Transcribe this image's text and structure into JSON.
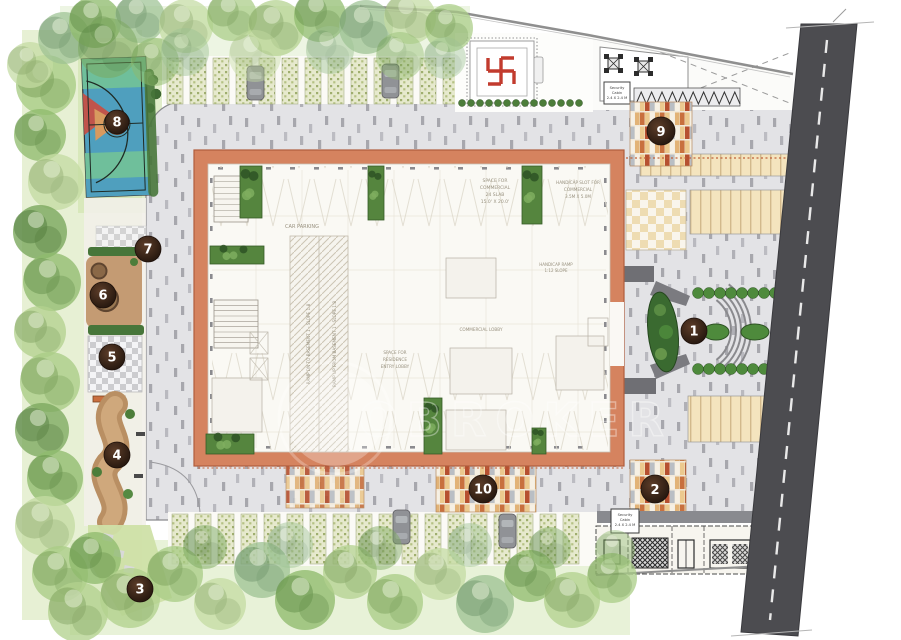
{
  "plan": {
    "watermark": "NOBROKER",
    "markers": [
      {
        "label": "1"
      },
      {
        "label": "2"
      },
      {
        "label": "3"
      },
      {
        "label": "4"
      },
      {
        "label": "5"
      },
      {
        "label": "6"
      },
      {
        "label": "7"
      },
      {
        "label": "8"
      },
      {
        "label": "9"
      },
      {
        "label": "10"
      }
    ],
    "labels": {
      "car_parking": "CAR PARKING",
      "space_commercial_1": "SPACE FOR",
      "space_commercial_2": "COMMERCIAL",
      "space_commercial_3": "24 SLAB",
      "space_commercial_4": "15.0' X 20.0'",
      "handicap_slot_1": "HANDICAP SLOT FOR",
      "handicap_slot_2": "COMMERCIAL",
      "handicap_slot_3": "3.5M X 5.0M",
      "handicap_ramp_1": "HANDICAP RAMP",
      "handicap_ramp_2": "1:12 SLOPE",
      "ramp_dn": "RAMP DN TO BASEMENT 1 - SLOPE 1:8",
      "ramp_up": "RAMP UP FROM BASEMENT 1 - SLOPE 1:8",
      "residence_lobby_1": "SPACE FOR",
      "residence_lobby_2": "RESIDENCE",
      "residence_lobby_3": "ENTRY LOBBY",
      "commercial_lobby": "COMMERCIAL LOBBY",
      "security_1": "Security",
      "security_2": "Cabin",
      "security_3": "2.4 X 2.4 M"
    },
    "icons": {
      "temple": "swastika-icon",
      "seating": "table-chairs-icon",
      "vehicle": "car-icon",
      "tree": "tree-icon",
      "court": "basketball-court-icon",
      "bench": "bench-icon"
    },
    "colors": {
      "road": "#4c4c50",
      "building_border": "#d5835f",
      "marker": "#352216",
      "court_blue": "#4f9fbe",
      "court_green": "#6fbf9b",
      "tile_orange": "#c8703e",
      "tree_green": "#78a058",
      "paver_gray": "#e3e3e6"
    }
  }
}
